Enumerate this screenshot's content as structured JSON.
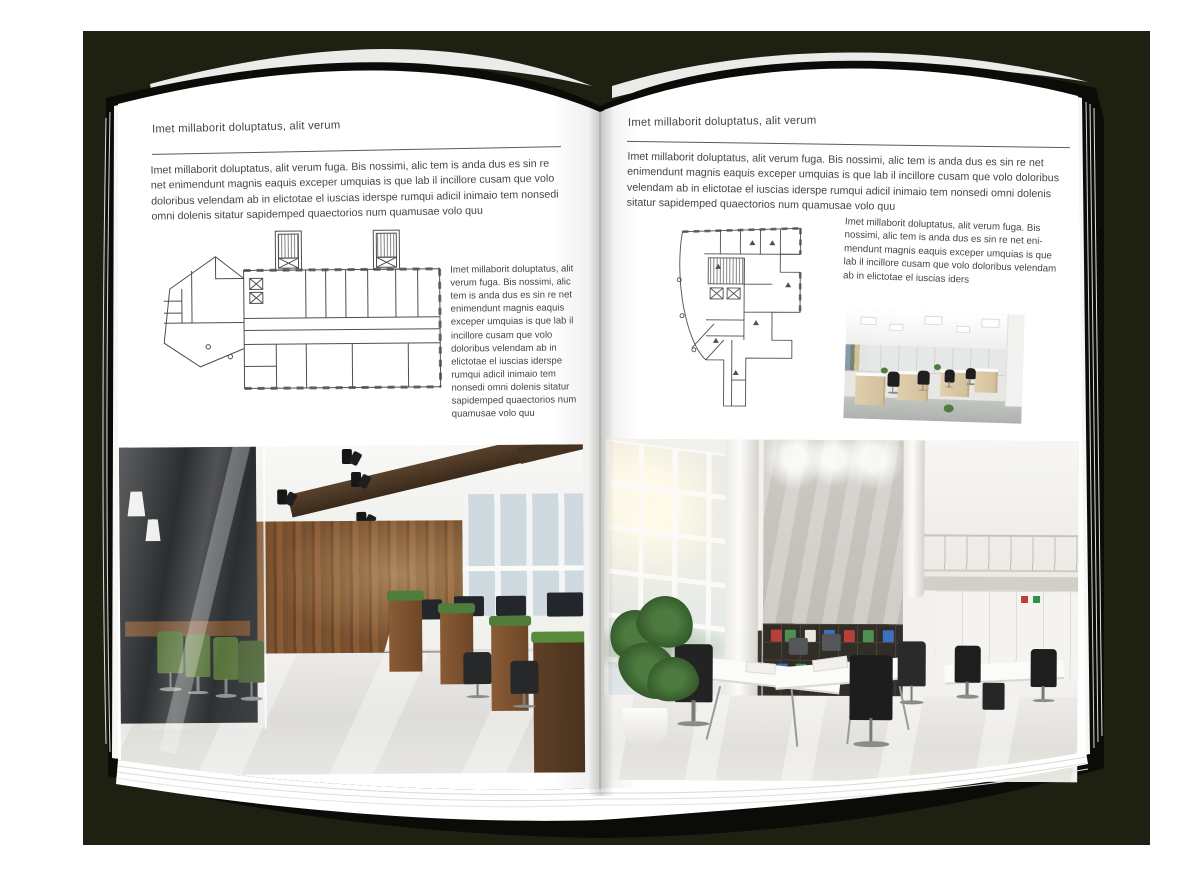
{
  "document": {
    "kind": "architecture-magazine-spread-mockup",
    "left_page": {
      "header": "Imet millaborit doluptatus, alit verum",
      "intro": "Imet millaborit doluptatus, alit verum fuga. Bis nossimi, alic tem is anda dus es sin re net enimendunt magnis eaquis exceper umquias is que lab il incillore cusam que volo doloribus velendam ab in elictotae el iuscias iderspe rumqui adicil inimaio tem nonsedi omni dolenis sitatur sapidemped quaectorios num quamusae volo quu",
      "side_text": "Imet millaborit doluptatus, alit verum fuga. Bis nossimi, alic tem is anda dus es sin re net enimendunt magnis eaquis exceper umquias is que lab il incillore cusam que volo doloribus velendam ab in elictotae el iuscias iderspe rumqui adicil inimaio tem nonsedi omni dolenis sitatur sapidemped quaectorios num quamusae volo quu",
      "figures": {
        "floor_plan": "office-building-floor-plan-drawing",
        "photo": "loft-style-office-interior-photo"
      }
    },
    "right_page": {
      "header": "Imet millaborit doluptatus, alit verum",
      "intro": "Imet millaborit doluptatus, alit verum fuga. Bis nossimi, alic tem is anda dus es sin re net enimendunt magnis eaquis exceper umquias is que lab il incillore cusam que volo doloribus velendam ab in elictotae el iuscias iderspe rumqui adicil inimaio tem nonsedi omni dolenis sitatur sapidemped quaectorios num quamusae volo quu",
      "side_text": "Imet millaborit doluptatus, alit verum fuga. Bis nossimi, alic tem is anda dus es sin re net eni-mendunt magnis eaquis exceper umquias is que lab il incillore cusam que volo doloribus velendam ab in elictotae el iuscias iders",
      "figures": {
        "floor_plan": "irregular-office-floor-plan-drawing",
        "photo_small": "open-plan-workstations-photo",
        "photo": "white-double-height-office-photo"
      }
    }
  },
  "colors": {
    "backdrop": "#1e2012",
    "cover": "#0b0c08",
    "page": "#ffffff",
    "text": "#454545",
    "rule": "#5a5a5a",
    "plan-line": "#4e4e4e",
    "wood": "#7c5230",
    "chair-green": "#4e6b2f",
    "plant-green": "#4f7d3a",
    "sky": "#cfd9e0",
    "concrete": "#cdcac4",
    "shelf": "#312e28",
    "binder-red": "#b5413a",
    "binder-green": "#4f8f4f",
    "binder-blue": "#3f6fbf"
  }
}
